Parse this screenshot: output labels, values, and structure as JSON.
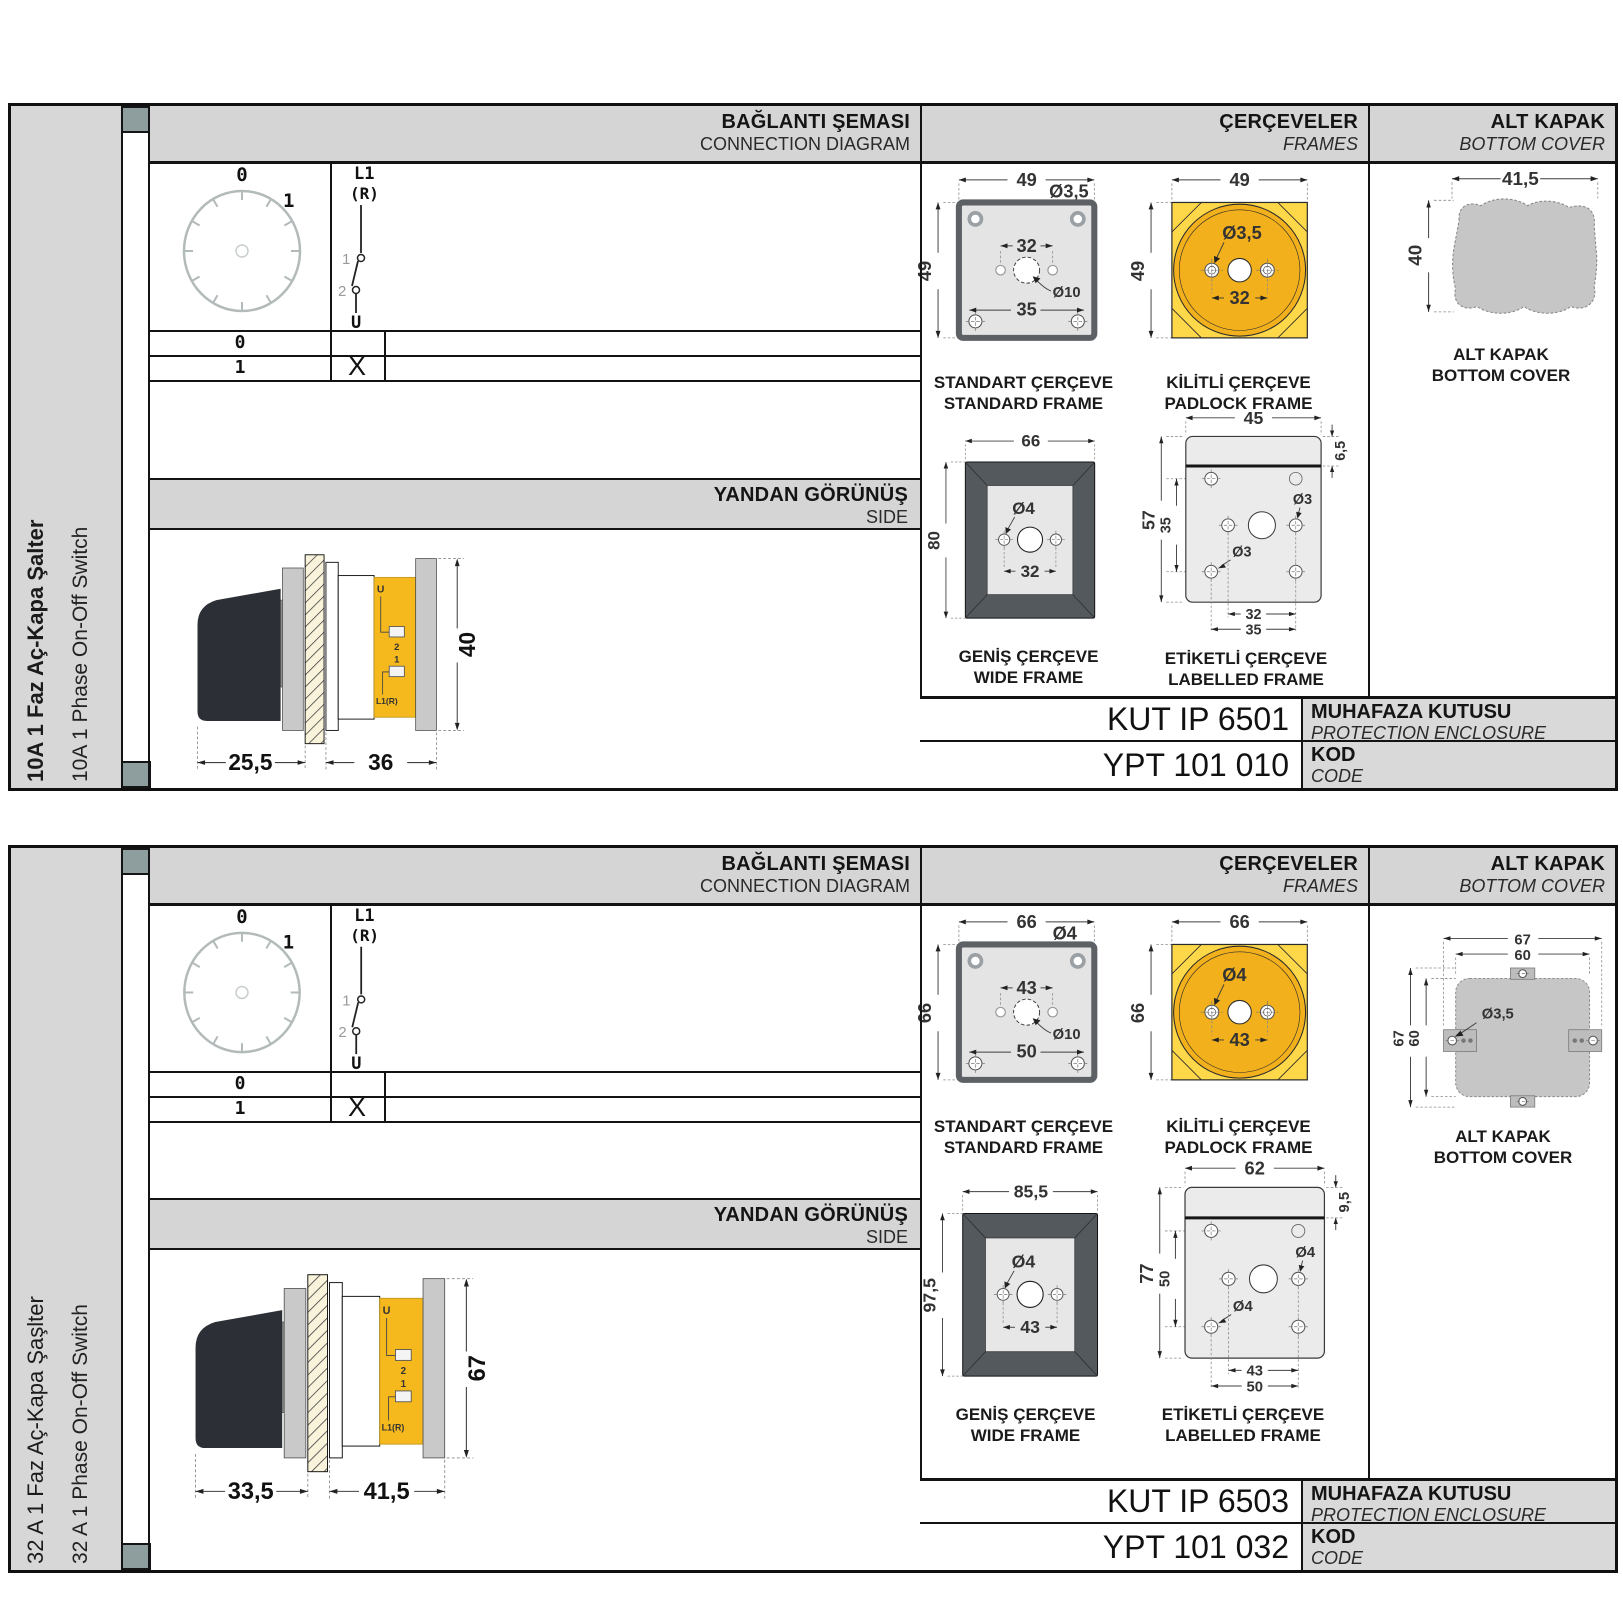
{
  "sections": [
    {
      "sidebar": {
        "title_tr": "10A 1 Faz Aç-Kapa Şalter",
        "title_en": "10A 1 Phase On-Off Switch"
      },
      "headers": {
        "connection_tr": "BAĞLANTI ŞEMASI",
        "connection_en": "CONNECTION DIAGRAM",
        "frames_tr": "ÇERÇEVELER",
        "frames_en": "FRAMES",
        "cover_tr": "ALT KAPAK",
        "cover_en": "BOTTOM COVER"
      },
      "connection": {
        "dial": {
          "pos0": "0",
          "pos1": "1"
        },
        "switch": {
          "top1": "L1",
          "top2": "(R)",
          "c1": "1",
          "c2": "2",
          "bottom": "U"
        },
        "table": {
          "row0_label": "0",
          "row0_mark": "",
          "row1_label": "1",
          "row1_mark": "X"
        }
      },
      "side_view": {
        "header_tr": "YANDAN GÖRÜNÜŞ",
        "header_en": "SIDE",
        "dim_depth_handle": "25,5",
        "dim_depth_body": "36",
        "dim_height": "40",
        "label_u": "U",
        "label_2": "2",
        "label_1": "1",
        "label_l1r": "L1(R)"
      },
      "frames": {
        "standard": {
          "cap_tr": "STANDART ÇERÇEVE",
          "cap_en": "STANDARD FRAME",
          "dim_w": "49",
          "dim_h": "49",
          "dim_corner_hole": "Ø3,5",
          "dim_mid_spacing": "32",
          "dim_center_hole": "Ø10",
          "dim_bottom_spacing": "35"
        },
        "padlock": {
          "cap_tr": "KİLİTLİ ÇERÇEVE",
          "cap_en": "PADLOCK FRAME",
          "dim_w": "49",
          "dim_h": "49",
          "dim_hole": "Ø3,5",
          "dim_spacing": "32"
        },
        "wide": {
          "cap_tr": "GENİŞ ÇERÇEVE",
          "cap_en": "WIDE FRAME",
          "dim_w": "66",
          "dim_h": "80",
          "dim_hole": "Ø4",
          "dim_spacing": "32"
        },
        "labelled": {
          "cap_tr": "ETİKETLİ ÇERÇEVE",
          "cap_en": "LABELLED FRAME",
          "dim_w": "45",
          "dim_h": "57",
          "dim_inner_h": "35",
          "dim_top": "6,5",
          "dim_hole_right": "Ø3",
          "dim_hole_left": "Ø3",
          "dim_bottom_inner": "32",
          "dim_bottom_outer": "35"
        }
      },
      "cover": {
        "cap_tr": "ALT KAPAK",
        "cap_en": "BOTTOM COVER",
        "dim_w": "41,5",
        "dim_h": "40"
      },
      "codes": {
        "enclosure_value": "KUT IP 6501",
        "enclosure_tr": "MUHAFAZA KUTUSU",
        "enclosure_en": "PROTECTION ENCLOSURE",
        "code_value": "YPT 101 010",
        "code_tr": "KOD",
        "code_en": "CODE"
      }
    },
    {
      "sidebar": {
        "title_tr": "32 A 1 Faz Aç-Kapa Şaşlter",
        "title_en": "32 A 1 Phase On-Off Switch"
      },
      "headers": {
        "connection_tr": "BAĞLANTI ŞEMASI",
        "connection_en": "CONNECTION DIAGRAM",
        "frames_tr": "ÇERÇEVELER",
        "frames_en": "FRAMES",
        "cover_tr": "ALT KAPAK",
        "cover_en": "BOTTOM COVER"
      },
      "connection": {
        "dial": {
          "pos0": "0",
          "pos1": "1"
        },
        "switch": {
          "top1": "L1",
          "top2": "(R)",
          "c1": "1",
          "c2": "2",
          "bottom": "U"
        },
        "table": {
          "row0_label": "0",
          "row0_mark": "",
          "row1_label": "1",
          "row1_mark": "X"
        }
      },
      "side_view": {
        "header_tr": "YANDAN GÖRÜNÜŞ",
        "header_en": "SIDE",
        "dim_depth_handle": "33,5",
        "dim_depth_body": "41,5",
        "dim_height": "67",
        "label_u": "U",
        "label_2": "2",
        "label_1": "1",
        "label_l1r": "L1(R)"
      },
      "frames": {
        "standard": {
          "cap_tr": "STANDART ÇERÇEVE",
          "cap_en": "STANDARD FRAME",
          "dim_w": "66",
          "dim_h": "66",
          "dim_corner_hole": "Ø4",
          "dim_mid_spacing": "43",
          "dim_center_hole": "Ø10",
          "dim_bottom_spacing": "50"
        },
        "padlock": {
          "cap_tr": "KİLİTLİ ÇERÇEVE",
          "cap_en": "PADLOCK FRAME",
          "dim_w": "66",
          "dim_h": "66",
          "dim_hole": "Ø4",
          "dim_spacing": "43"
        },
        "wide": {
          "cap_tr": "GENİŞ ÇERÇEVE",
          "cap_en": "WIDE FRAME",
          "dim_w": "85,5",
          "dim_h": "97,5",
          "dim_hole": "Ø4",
          "dim_spacing": "43"
        },
        "labelled": {
          "cap_tr": "ETİKETLİ ÇERÇEVE",
          "cap_en": "LABELLED FRAME",
          "dim_w": "62",
          "dim_h": "77",
          "dim_inner_h": "50",
          "dim_top": "9,5",
          "dim_hole_right": "Ø4",
          "dim_hole_left": "Ø4",
          "dim_bottom_inner": "43",
          "dim_bottom_outer": "50"
        }
      },
      "cover": {
        "cap_tr": "ALT KAPAK",
        "cap_en": "BOTTOM COVER",
        "dim_w_outer": "67",
        "dim_w_inner": "60",
        "dim_h_outer": "67",
        "dim_h_inner": "60",
        "dim_hole": "Ø3,5"
      },
      "codes": {
        "enclosure_value": "KUT IP 6503",
        "enclosure_tr": "MUHAFAZA KUTUSU",
        "enclosure_en": "PROTECTION ENCLOSURE",
        "code_value": "YPT 101 032",
        "code_tr": "KOD",
        "code_en": "CODE"
      }
    }
  ]
}
